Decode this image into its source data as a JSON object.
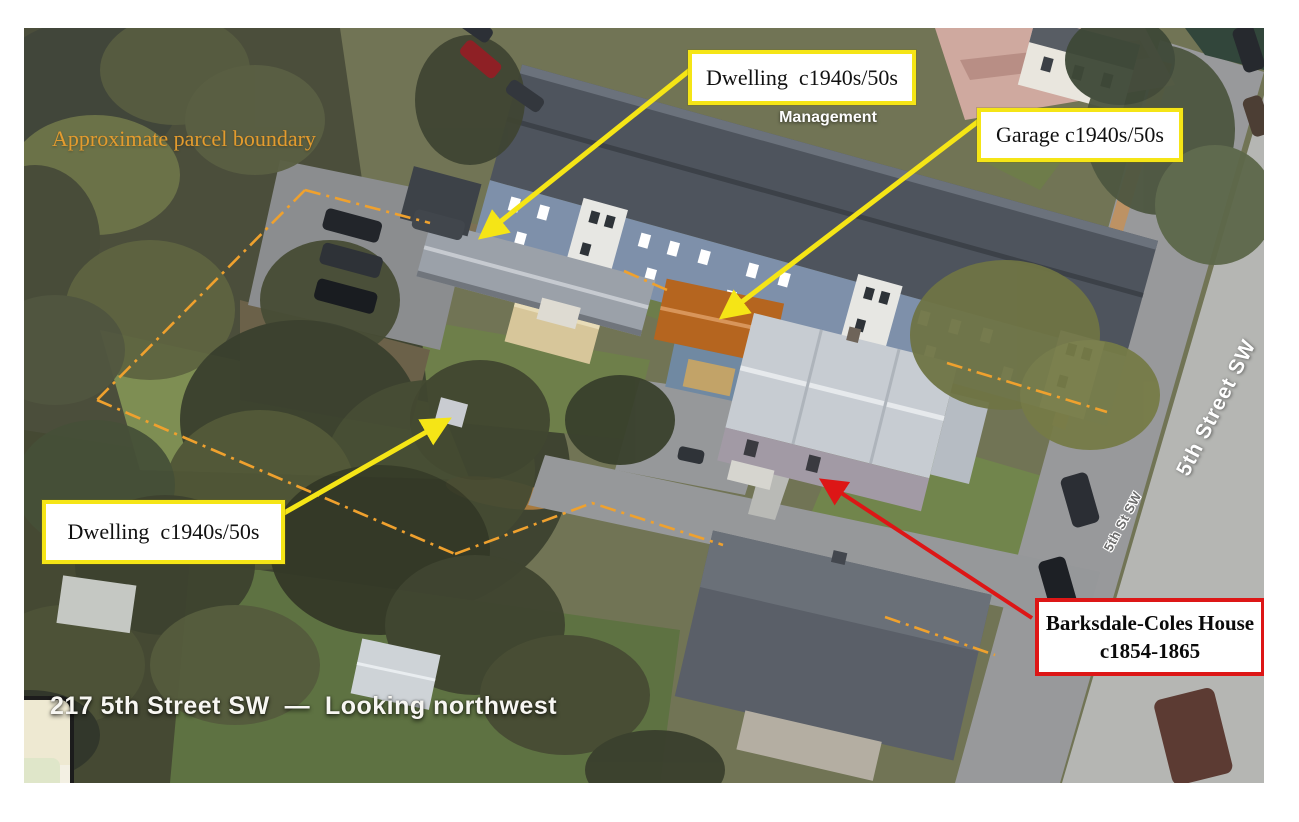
{
  "photo": {
    "caption": "217 5th Street SW  —  Looking northwest"
  },
  "annotations": {
    "parcel_boundary_text": "Approximate parcel boundary",
    "dwelling_top_label": "Dwelling  c1940s/50s",
    "garage_label": "Garage c1940s/50s",
    "dwelling_left_label": "Dwelling  c1940s/50s",
    "barksdale_label_line1": "Barksdale-Coles House",
    "barksdale_label_line2": "c1854-1865"
  },
  "map_labels": {
    "place_label_line1": "Braddock Property",
    "place_label_line2": "Management",
    "street_label_main": "5th Street SW",
    "street_label_small": "5th St SW"
  },
  "colors": {
    "annotation_yellow": "#f5e516",
    "annotation_red": "#dd1616",
    "boundary_orange": "#efa12e",
    "parcel_text_orange": "#e39b2e",
    "caption_white": "#f7f6f2"
  }
}
